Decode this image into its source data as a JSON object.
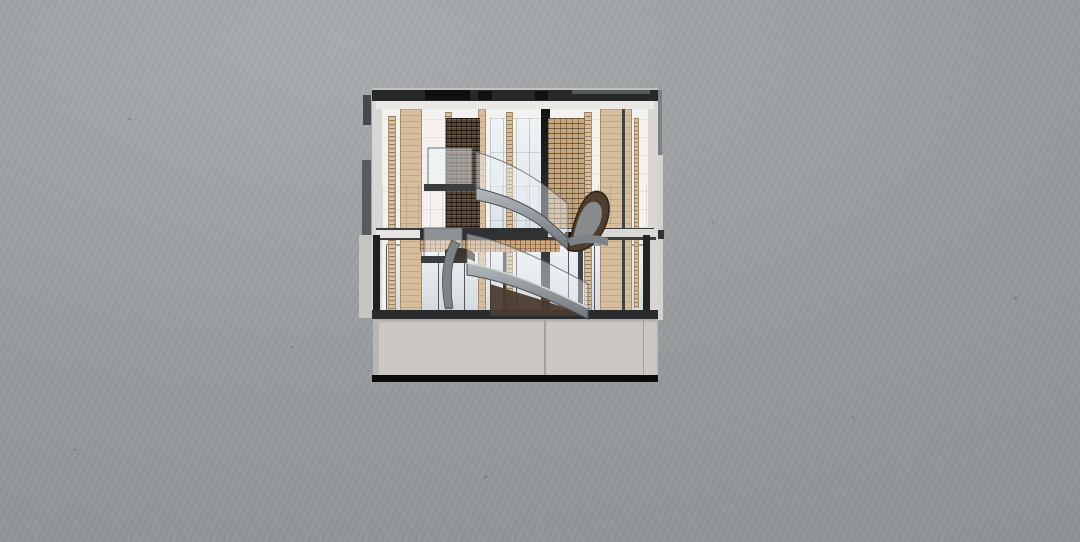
{
  "scene": {
    "description": "Rendered architectural cross-section of a two-storey timber pavilion with a sculptural S-curved stair and a concrete basement, centered on a cast-concrete grey backdrop",
    "render_type": "architectural-section-render",
    "visible_text": "none"
  },
  "parts": {
    "background": "cast concrete wall backdrop",
    "roof": "dark roof slab with rooftop equipment blocks",
    "upper_floor": "upper storey with timber-brick screen walls and slat-clad columns",
    "atrium": "central atrium glazing",
    "stair": "curved steel stair with glass balustrades and timber-brick clad stringer",
    "ground_floor": "full-height storefront glazing between timber columns",
    "slabs": "intermediate floor slab and ground slab",
    "basement": "concrete basement volume with panel joint",
    "fins": "projecting side wall fins"
  },
  "colors": {
    "bg_light": "#a8acae",
    "bg_mid": "#979b9d",
    "bg_dark": "#8b8f91",
    "roof_dark": "#26282a",
    "roof_black": "#0e0f10",
    "roof_top_line": "#c2c2c0",
    "ceiling": "#e9e8e5",
    "wall_white": "#f3f2ef",
    "wall_gray": "#d7d6d2",
    "wood_light": "#d6bd9c",
    "wood_edge": "#a98e6c",
    "brick_dark": "#5a4635",
    "brick_light": "#c6a67c",
    "glass_atrium": "#e7ebee",
    "glass_storefront": "#dde3e7",
    "mullion": "#3c4145",
    "slab_dark": "#2f3133",
    "slab_light": "#e6e5e1",
    "ground_slab": "#292b2c",
    "basement_face": "#cbc8c4",
    "basement_shade": "#b9b6b1",
    "basement_joint": "#a5a19c",
    "base_black": "#0b0b0b",
    "fin_dark": "#45484c",
    "fin_gray": "#7e8184",
    "fin_light": "#d3d2ce",
    "cut_dark": "#1e1f20",
    "steel_light": "#b3b8bb",
    "steel_dark": "#6f7578",
    "steel_edge": "#4b5053",
    "horn_fill": "#4e3e2e",
    "horn_edge": "#2e2318",
    "soffit_tan": "#cfa87c",
    "landing_floor": "#3a3c3e"
  }
}
